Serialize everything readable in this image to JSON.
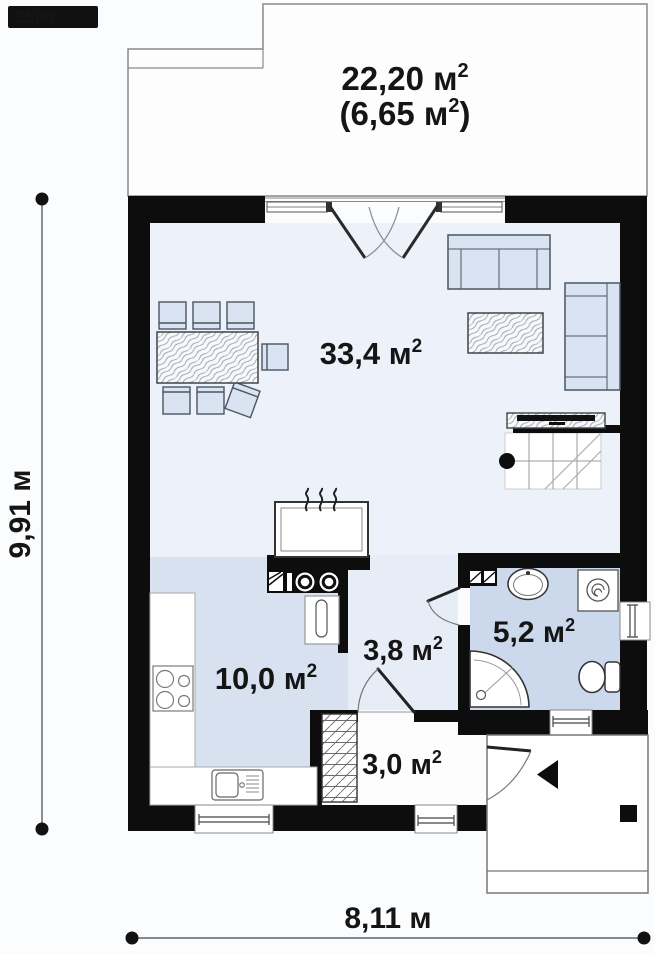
{
  "logo": {
    "text": "Z500",
    "sup": "©"
  },
  "labels": {
    "terrace_total": {
      "pre": "22,20 м",
      "sup": "2",
      "post": ""
    },
    "terrace_covered": {
      "pre": "(6,65 м",
      "sup": "2",
      "post": ")"
    },
    "living": {
      "pre": "33,4 м",
      "sup": "2",
      "post": ""
    },
    "kitchen": {
      "pre": "10,0 м",
      "sup": "2",
      "post": ""
    },
    "hallway": {
      "pre": "3,8 м",
      "sup": "2",
      "post": ""
    },
    "bathroom": {
      "pre": "5,2 м",
      "sup": "2",
      "post": ""
    },
    "entry": {
      "pre": "3,0 м",
      "sup": "2",
      "post": ""
    }
  },
  "dimensions": {
    "height": "9,91 м",
    "width": "8,11 м"
  },
  "colors": {
    "wall": "#0d0d0d",
    "living_floor": "#ecf1fa",
    "kitchen_floor": "#d7e1f0",
    "bathroom_floor": "#ccd9ec",
    "hallway_floor": "#e7edf7",
    "entry_floor": "#fdfdfe",
    "furniture_fill": "#d9e3f1",
    "furniture_stroke": "#4a5663",
    "thin_line": "#777777",
    "label_text": "#151515",
    "logo_bg": "#111111"
  }
}
